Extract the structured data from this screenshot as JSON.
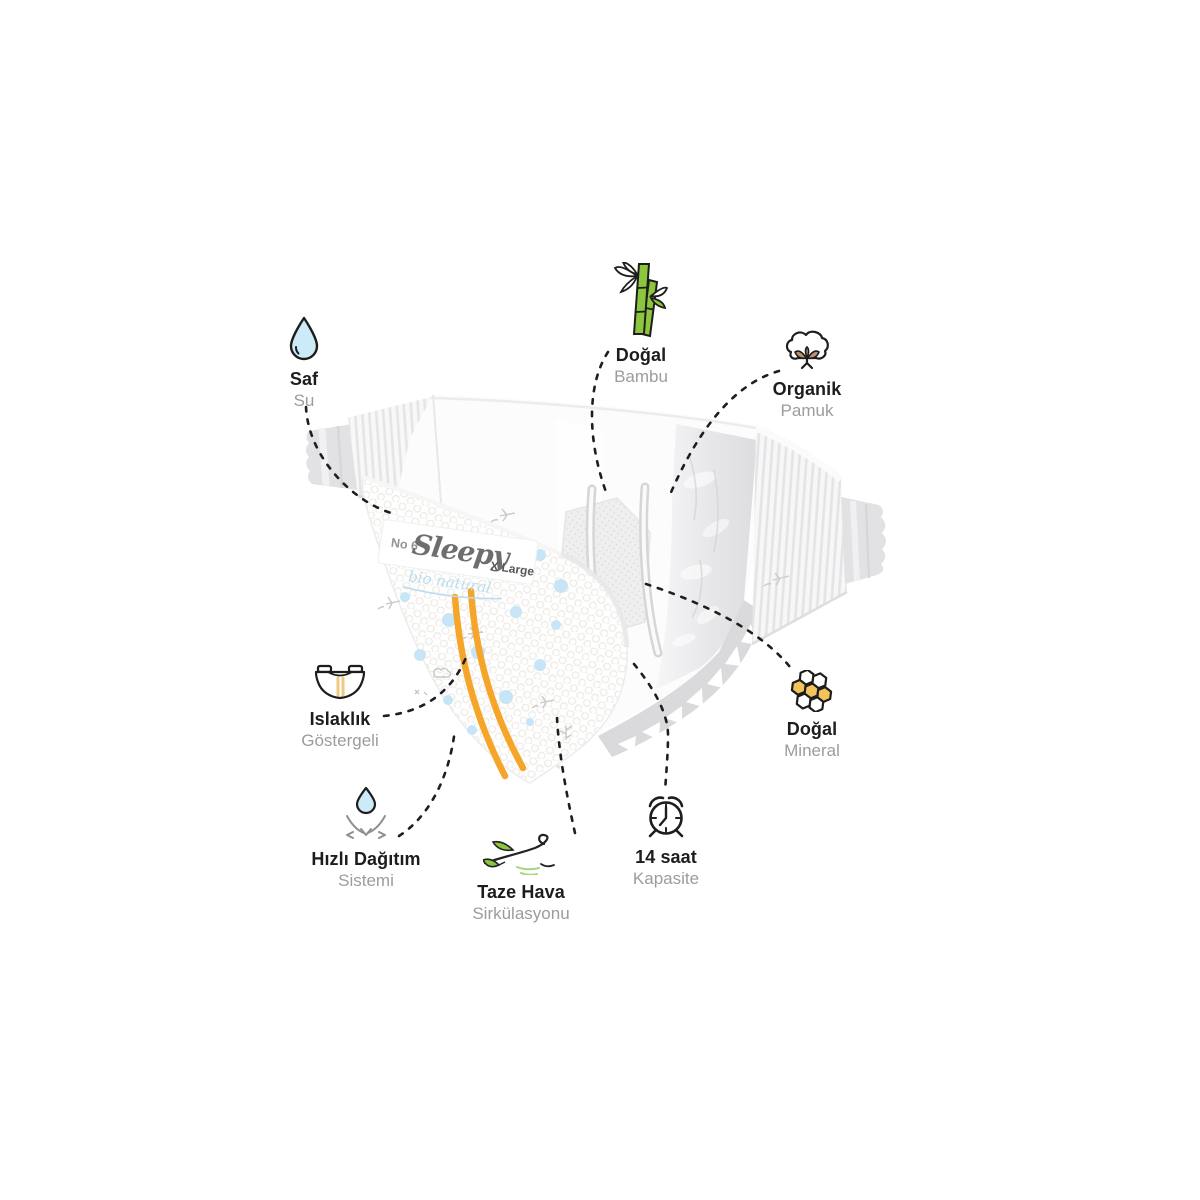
{
  "product_label": {
    "size_number": "No 6",
    "brand": "Sleepy",
    "size_name": "X Large",
    "sub_brand": "bio natural"
  },
  "features": [
    {
      "id": "saf-su",
      "title": "Saf",
      "subtitle": "Su",
      "icon": "water-drop"
    },
    {
      "id": "dogal-bambu",
      "title": "Doğal",
      "subtitle": "Bambu",
      "icon": "bamboo"
    },
    {
      "id": "organik-pamuk",
      "title": "Organik",
      "subtitle": "Pamuk",
      "icon": "cotton"
    },
    {
      "id": "islaklik-gostergeli",
      "title": "Islaklık",
      "subtitle": "Göstergeli",
      "icon": "diaper-wetness-indicator"
    },
    {
      "id": "dogal-mineral",
      "title": "Doğal",
      "subtitle": "Mineral",
      "icon": "honeycomb"
    },
    {
      "id": "hizli-dagitim",
      "title": "Hızlı Dağıtım",
      "subtitle": "Sistemi",
      "icon": "drop-absorb-arrows"
    },
    {
      "id": "taze-hava",
      "title": "Taze Hava",
      "subtitle": "Sirkülasyonu",
      "icon": "wind-leaves"
    },
    {
      "id": "on-dort-saat",
      "title": "14 saat",
      "subtitle": "Kapasite",
      "icon": "alarm-clock"
    }
  ],
  "colors": {
    "text_primary": "#1d1d1b",
    "text_secondary": "#9c9c9c",
    "callout_line": "#1e1e1e",
    "stripe_orange": "#f5a62a",
    "drop_blue": "#cdeaf8",
    "dot_blue": "#c7e5f6",
    "leaf_green": "#8cc63e",
    "honey_yellow": "#f3c35c",
    "cotton_rose": "#c08d76",
    "label_script_blue": "#b9dcf0"
  }
}
